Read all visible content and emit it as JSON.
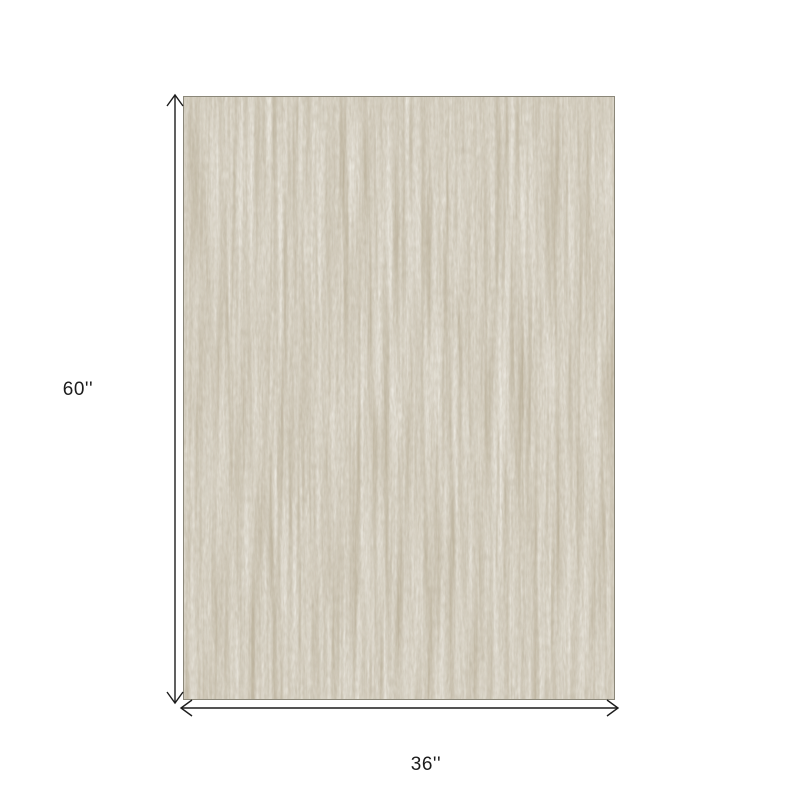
{
  "diagram": {
    "type": "product-dimensions",
    "subject": "rug-swatch",
    "height_label": "60''",
    "width_label": "36''"
  },
  "colors": {
    "background": "#ffffff",
    "dimension_line": "#1c1c1c",
    "label_text": "#1c1c1c",
    "rug_base": "#dcd7cb",
    "rug_thread_dark": "#b7ac94",
    "rug_thread_light": "#f4f2ec",
    "rug_grain": "#a89d87",
    "rug_edge": "#8b8779"
  }
}
